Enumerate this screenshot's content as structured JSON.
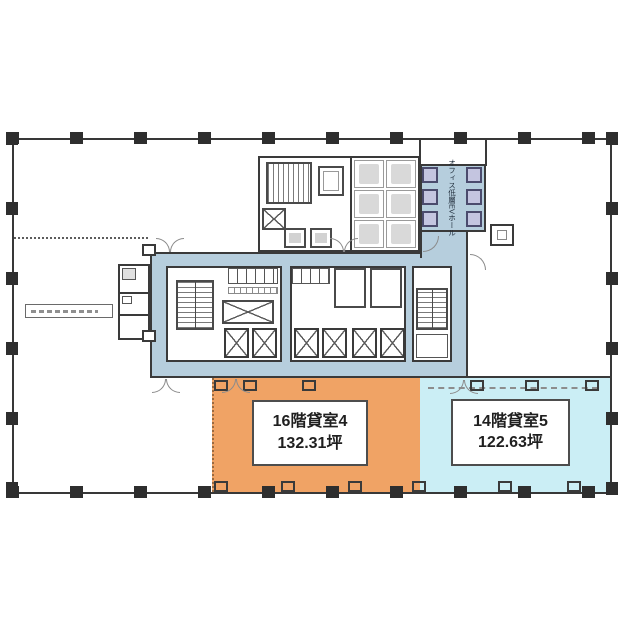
{
  "plan": {
    "units": [
      {
        "name": "16階貸室4",
        "area": "132.31坪",
        "fill": "#F0A365"
      },
      {
        "name": "14階貸室5",
        "area": "122.63坪",
        "fill": "#CBEEF5"
      }
    ],
    "core": {
      "ev_hall_label": "オフィス低層EVホール"
    },
    "colors": {
      "corridor": "#B6CEDD",
      "elevator_shaft": "#C4C5E0",
      "unit_orange": "#F0A365",
      "unit_blue": "#CBEEF5",
      "wall": "#383838"
    }
  }
}
